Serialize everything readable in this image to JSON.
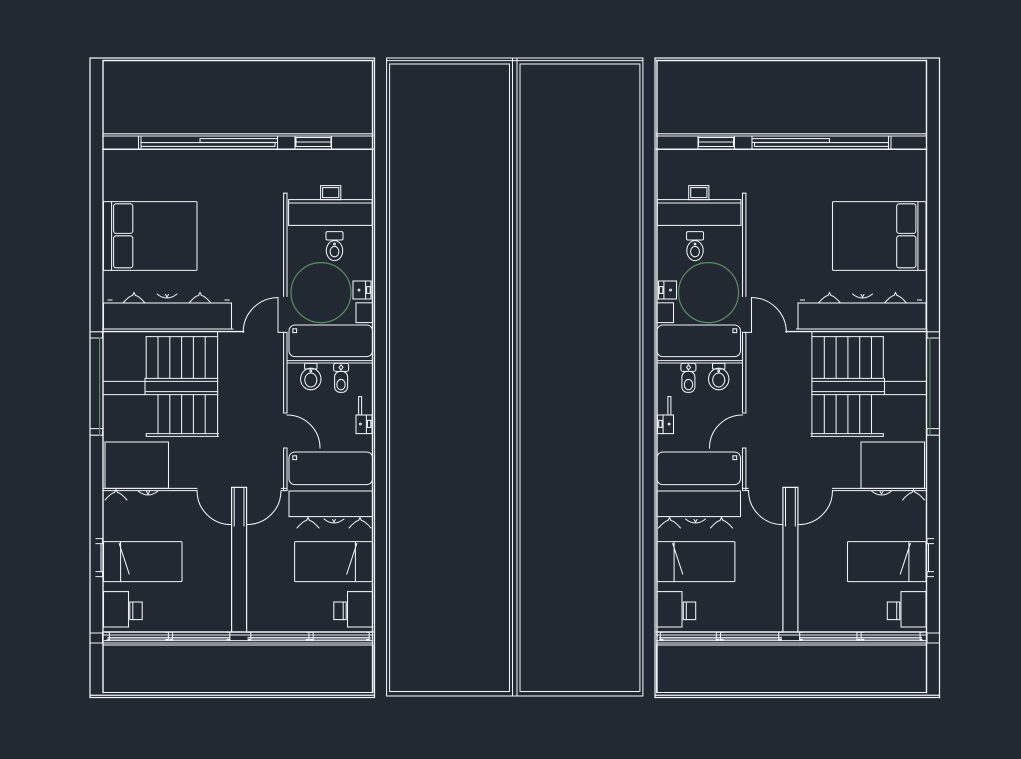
{
  "canvas": {
    "kind": "cad-model-space",
    "background": "#232933"
  },
  "colors": {
    "background": "#232933",
    "line": "#eff3f6",
    "accent_green": "#55925f"
  },
  "plan": {
    "type": "residential-upper-floor-plan",
    "units": [
      {
        "id": "unit-a",
        "side": "left",
        "mirrored": false
      },
      {
        "id": "unit-b",
        "side": "right",
        "mirrored": true
      }
    ],
    "light_shafts_per_unit": 1,
    "per_unit_elements": {
      "terrace": 1,
      "balcony": 1,
      "double_bed": 1,
      "single_beds": 2,
      "desks_with_chairs": 2,
      "wardrobes": 3,
      "stair_flights": 2,
      "bathrooms": 2,
      "bathtubs": 2,
      "toilets": 2,
      "bidet": 1,
      "shower_circle": 1,
      "vanity_counter": 1,
      "wall_washbasins": 2,
      "sliding_window_panes": 2,
      "windows": 4,
      "door_arcs": 5
    }
  }
}
